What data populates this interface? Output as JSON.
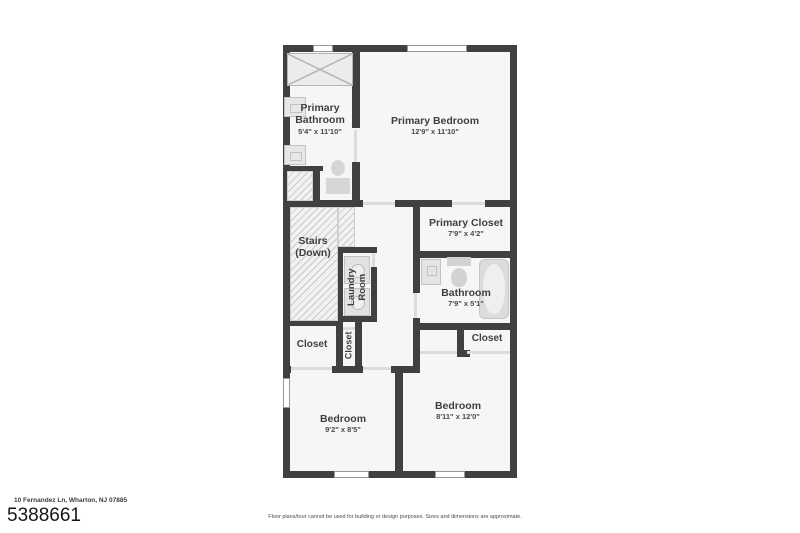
{
  "footer": {
    "address": "10 Fernandez Ln, Wharton, NJ 07885",
    "listing_id": "5388661",
    "disclaimer": "Floor plans/tour cannot be used for building or design purposes. Sizes and dimensions are approximate."
  },
  "colors": {
    "wall": "#404040",
    "room_fill": "#f6f6f6",
    "fixture_fill": "#e7e7e7",
    "hatch_line": "#c9c9c9",
    "label_text": "#3f3f3f"
  },
  "rooms": {
    "primary_bathroom": {
      "name": "Primary Bathroom",
      "dims": "5'4\" x 11'10\""
    },
    "primary_bedroom": {
      "name": "Primary Bedroom",
      "dims": "12'9\" x 11'10\""
    },
    "primary_closet": {
      "name": "Primary Closet",
      "dims": "7'9\" x 4'2\""
    },
    "stairs": {
      "name": "Stairs (Down)"
    },
    "laundry": {
      "name": "Laundry Room"
    },
    "bathroom": {
      "name": "Bathroom",
      "dims": "7'9\" x 5'1\""
    },
    "closet_left": {
      "name": "Closet"
    },
    "closet_middle": {
      "name": "Closet"
    },
    "closet_right": {
      "name": "Closet"
    },
    "bedroom_left": {
      "name": "Bedroom",
      "dims": "9'2\" x 8'5\""
    },
    "bedroom_right": {
      "name": "Bedroom",
      "dims": "8'11\" x 12'0\""
    }
  }
}
